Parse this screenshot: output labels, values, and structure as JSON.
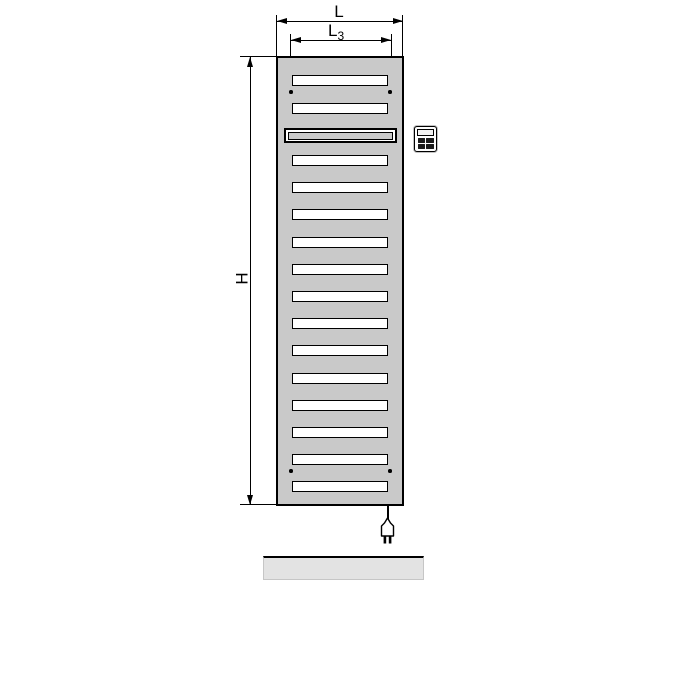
{
  "dimensions": {
    "overall_width": {
      "label": "L"
    },
    "inner_width": {
      "label_main": "L",
      "label_sub": "3"
    },
    "height": {
      "label": "H"
    }
  },
  "radiator": {
    "bar_count": 16,
    "slot_count": 15,
    "heating_element_bar_count": 1,
    "mounting_hole_count": 4
  },
  "icons": {
    "control_unit": "control-unit-icon",
    "power_plug": "power-plug-icon"
  },
  "colors": {
    "radiator_fill": "#c9c9c9",
    "slot_fill": "#ffffff",
    "line": "#000000",
    "floor_fill": "#e3e3e3"
  }
}
